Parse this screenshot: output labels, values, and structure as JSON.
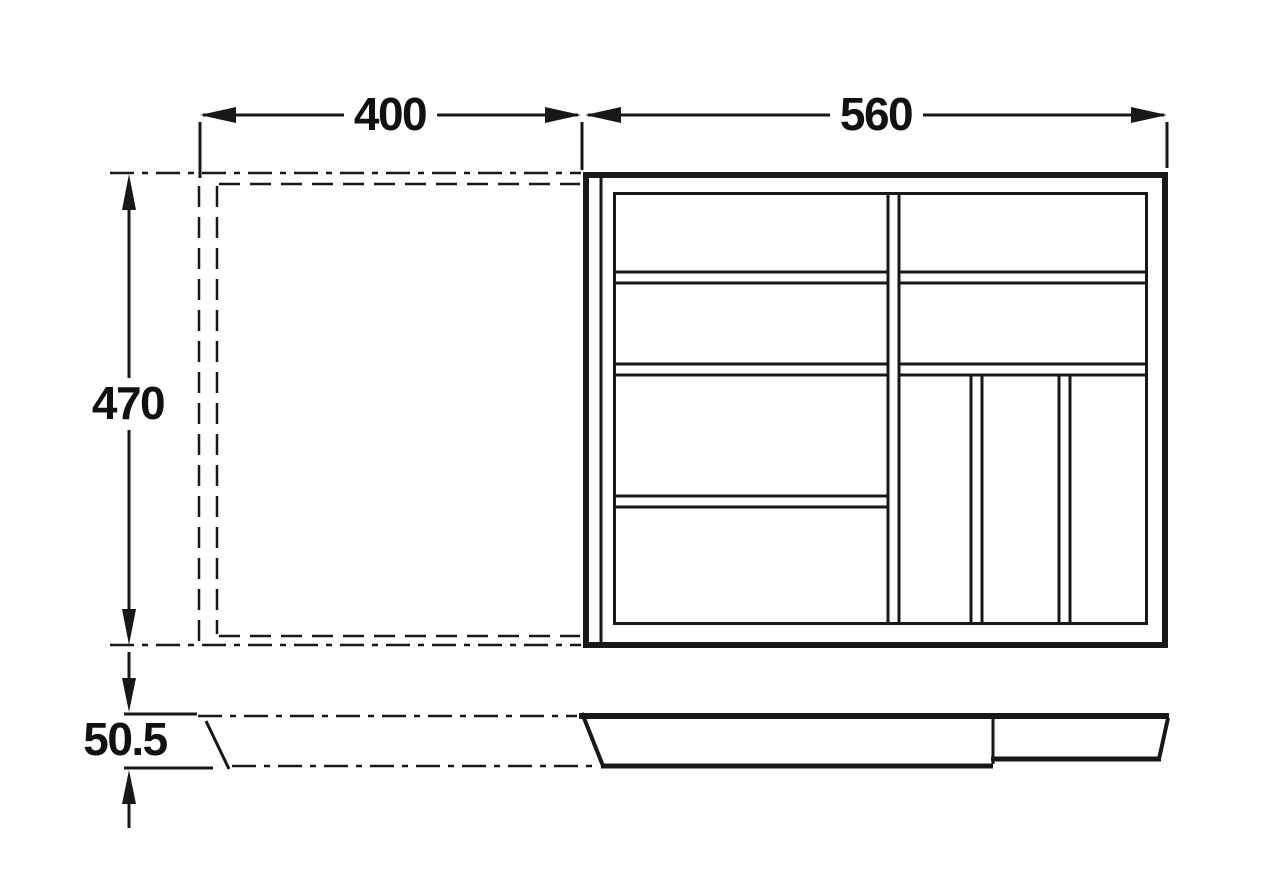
{
  "diagram": {
    "type": "technical-dimension-drawing",
    "subject": "cutlery tray drawer insert, top view with compartments and side profile view",
    "background_color": "#ffffff",
    "line_color": "#181818",
    "units_shown": "none (numeric only)",
    "dimensions": {
      "extension_width": {
        "label": "400"
      },
      "tray_width": {
        "label": "560"
      },
      "tray_depth": {
        "label": "470"
      },
      "tray_height": {
        "label": "50.5"
      }
    },
    "top_view": {
      "compartments_left_column_rows": 4,
      "compartments_right_column_top_rows": 2,
      "compartments_right_column_bottom_slots": 3
    },
    "line_styles": {
      "phantom_extended_position": "dash-dot chain lines",
      "solid_object": "solid lines"
    }
  }
}
